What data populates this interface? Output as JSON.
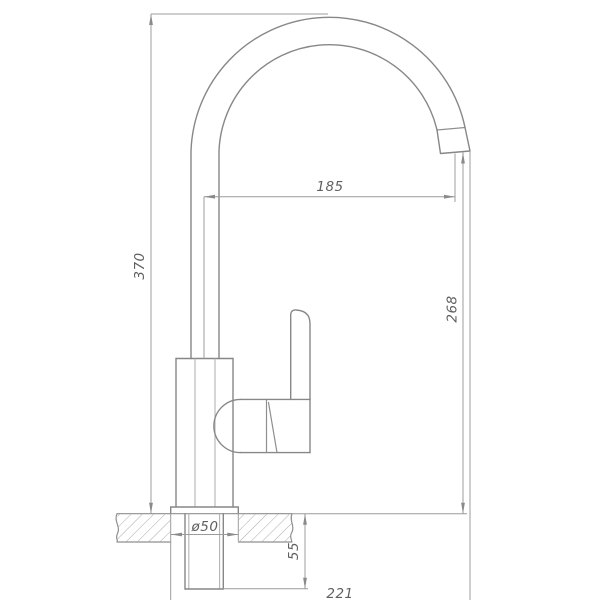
{
  "drawing": {
    "kind": "technical dimension drawing",
    "subject": "single-lever kitchen faucet, side elevation with countertop cross-section",
    "background_color": "#ffffff",
    "object_line_color": "#878787",
    "dimension_line_color": "#9c9c9c",
    "text_color": "#5f5f5f",
    "hatch_color": "#ababab"
  },
  "dimensions": {
    "overall_height": "370",
    "spout_reach": "185",
    "outlet_height": "268",
    "under_deck_depth": "55",
    "base_diameter": "ø50",
    "overall_reach": "221"
  }
}
